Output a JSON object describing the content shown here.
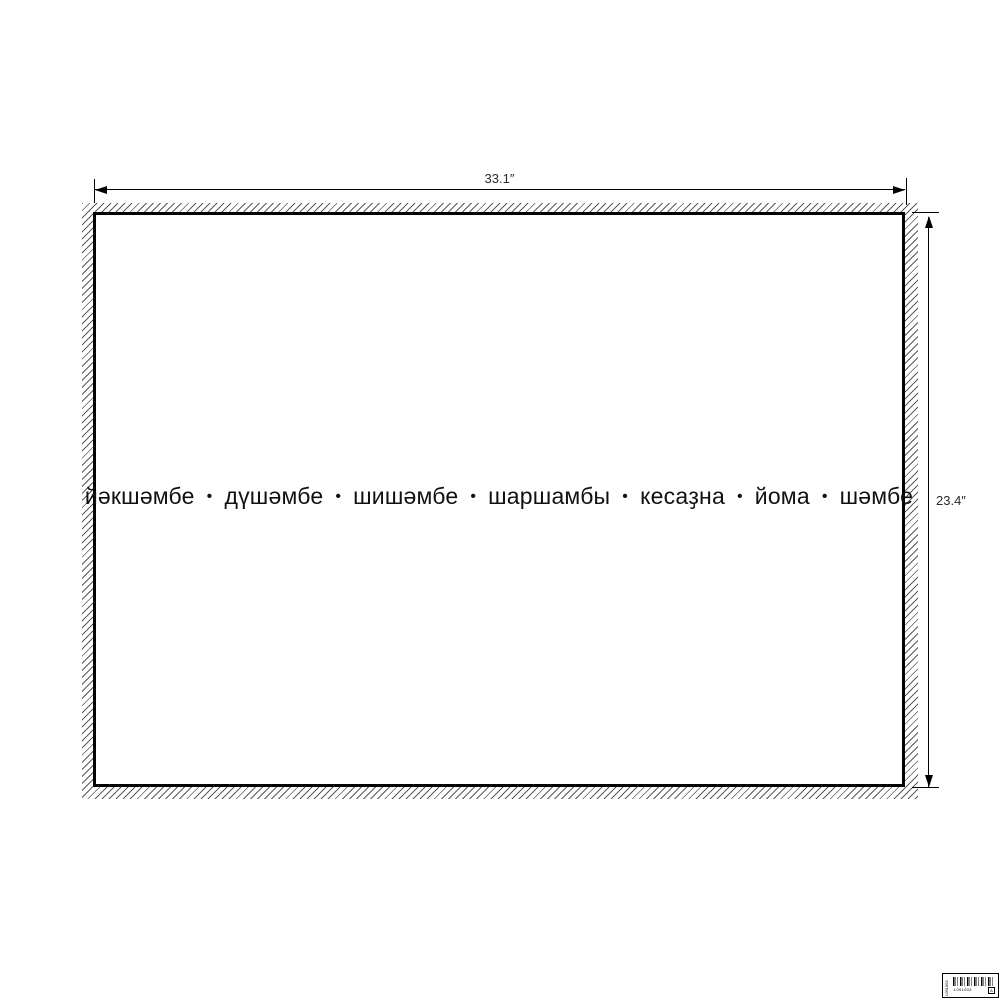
{
  "colors": {
    "background": "#ffffff",
    "poster_border": "#000000",
    "hatch": "#5a5a5a",
    "dimension_line": "#000000",
    "dimension_text": "#2b2b2b",
    "weekday_text": "#111111"
  },
  "dimensions": {
    "width_label": "33.1″",
    "height_label": "23.4″"
  },
  "poster": {
    "days": [
      "йәкшәмбе",
      "дүшәмбе",
      "шишәмбе",
      "шаршамбы",
      "кесаҙна",
      "йома",
      "шәмбе"
    ],
    "separator": "•"
  },
  "barcode_label": {
    "vertical_text": "L091003",
    "code_text": "L091003",
    "corner_mark": "A"
  }
}
